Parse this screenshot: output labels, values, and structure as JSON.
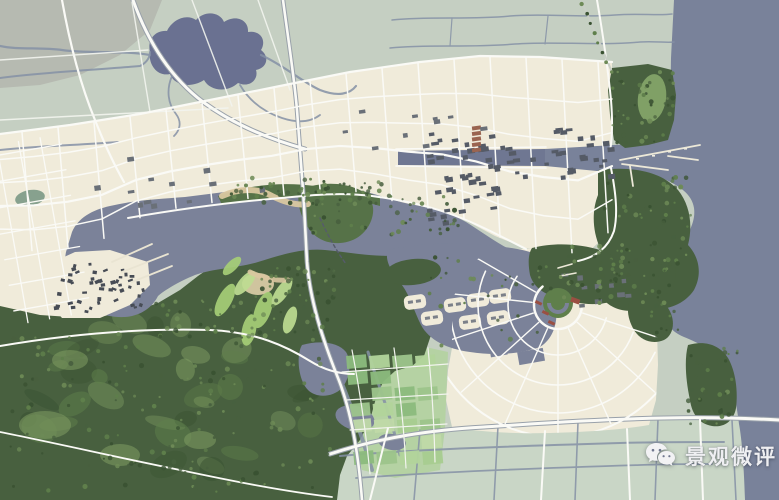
{
  "watermark": {
    "text": "景观微评",
    "icon": "wechat-logo"
  },
  "colors": {
    "farmland": "#c5cfc2",
    "farmland_gray": "#b6bab1",
    "farmland_bottom": "#c9d6c6",
    "urban": "#f0ebda",
    "road": "#fafaf6",
    "road_casing": "#99a1aa",
    "sea": "#79829a",
    "lake": "#7b8299",
    "lake_top": "#6a7191",
    "stream": "#8591a6",
    "canal_street": "#6f7792",
    "forest": "#48603f",
    "forest_dark": "#3a5232",
    "forest_light": "#5f7f4b",
    "park": "#567248",
    "glade": "#7f9c63",
    "golf": "#a6ce77",
    "golf_light": "#bedc92",
    "sand": "#cfc49e",
    "beach": "#d9c7a0",
    "building": "#555b66",
    "building_dark": "#474c55",
    "building_red": "#9a6450",
    "landmark_red": "#9a4f42",
    "pier": "#ece8d8",
    "pond_teal": "#87a18e",
    "fields": [
      "#9dc48b",
      "#b2d49b",
      "#8cba7d",
      "#c0d9a8",
      "#a8cc90"
    ],
    "tree_palette": [
      "#3a5232",
      "#48603f",
      "#5f7f4b",
      "#6d8a56"
    ]
  }
}
